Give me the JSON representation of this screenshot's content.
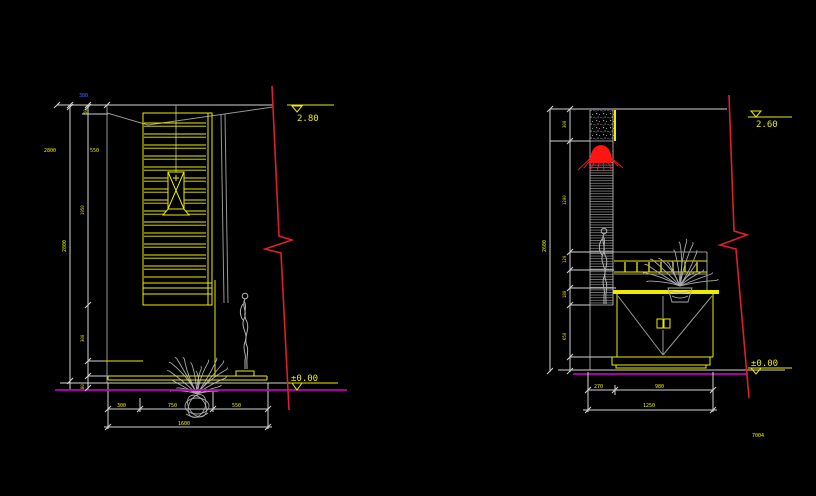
{
  "colors": {
    "background": "#000000",
    "line_yellow": "#ecec00",
    "line_white": "#d4d4d4",
    "line_gray": "#969696",
    "line_red": "#de1e2c",
    "line_magenta": "#bc00bc",
    "text_blue": "#4664ff"
  },
  "left": {
    "level_top": "2.80",
    "level_floor": "±0.00",
    "dim_total_height": "2800",
    "dim_label_a": "2800",
    "dim_label_b": "550",
    "dim_label_blue": "380",
    "dim_label_small": "50",
    "dim_side": [
      "1950",
      "300",
      "80"
    ],
    "dim_bottom": [
      "300",
      "750",
      "550"
    ],
    "dim_bottom_total": "1600"
  },
  "right": {
    "level_top": "2.60",
    "level_floor": "±0.00",
    "dim_total_height": "2600",
    "dim_side": [
      "300",
      "1200",
      "120",
      "180",
      "650"
    ],
    "dim_bottom": [
      "270",
      "980"
    ],
    "dim_bottom_total": "1250",
    "sheet_note": "7004"
  }
}
